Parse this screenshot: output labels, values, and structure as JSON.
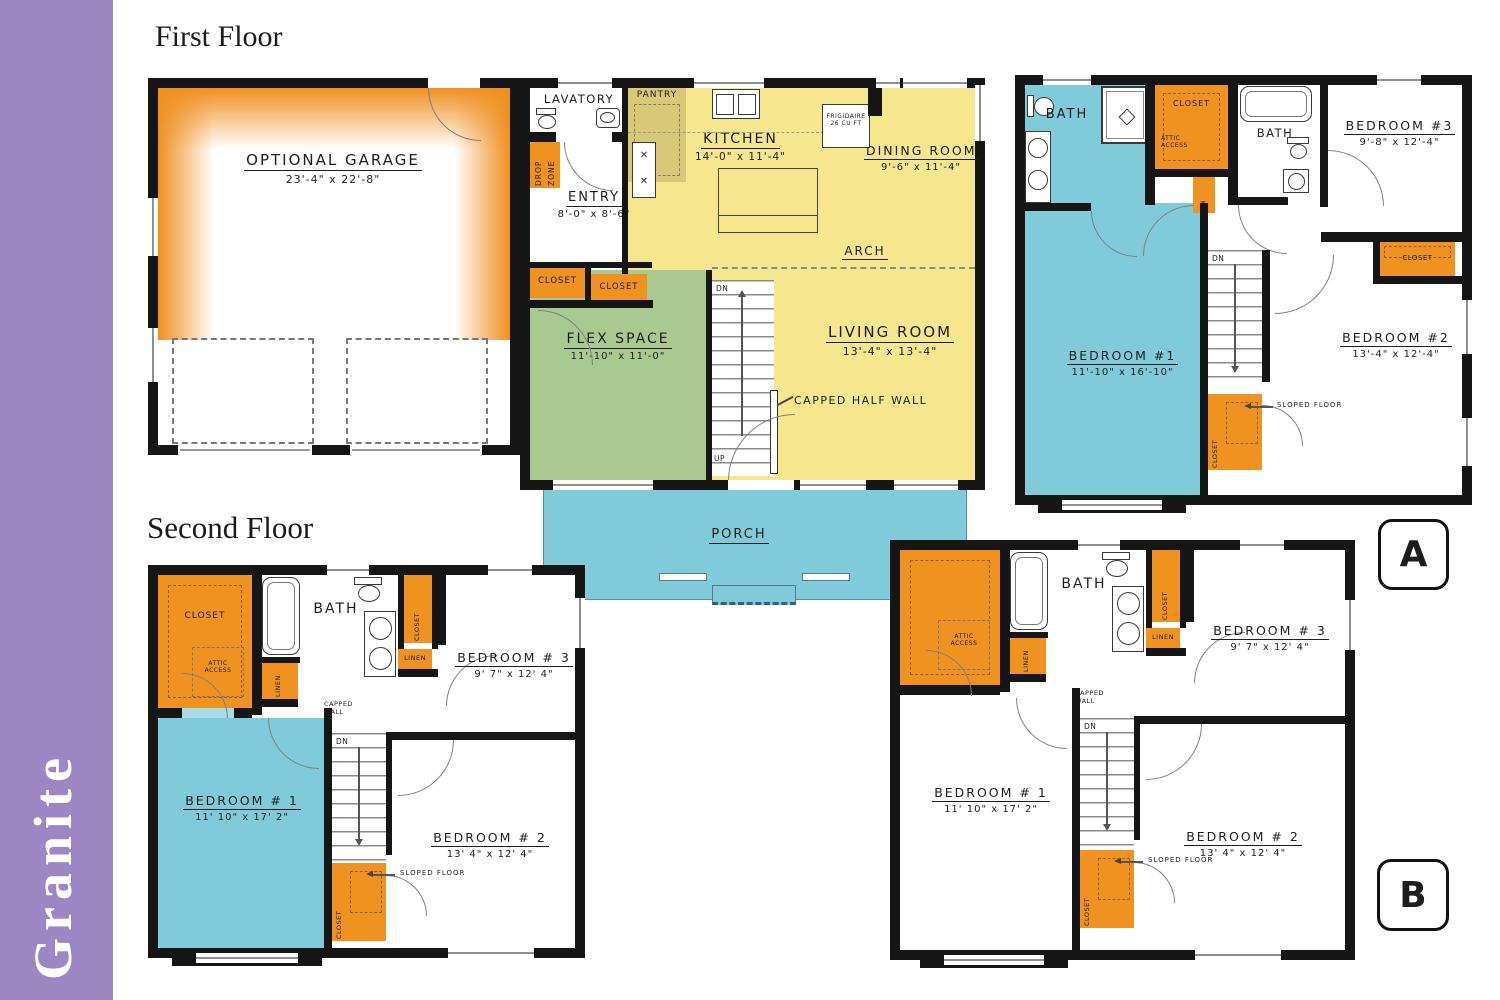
{
  "sidebar": {
    "title": "Granite"
  },
  "sections": {
    "first": "First Floor",
    "second": "Second Floor"
  },
  "badges": {
    "a": "A",
    "b": "B"
  },
  "colors": {
    "purple": "#9c86c3",
    "orange": "#f09220",
    "yellow": "#f6e68d",
    "tan": "#d8c878",
    "green": "#a8ca90",
    "teal": "#80cbd9",
    "wall": "#161616"
  },
  "ff": {
    "garage": {
      "name": "OPTIONAL GARAGE",
      "dims": "23'-4\" x 22'-8\""
    },
    "lavatory": "LAVATORY",
    "pantry": "PANTRY",
    "kitchen": {
      "name": "KITCHEN",
      "dims": "14'-0\" x 11'-4\""
    },
    "fridge": {
      "line1": "FRIGIDAIRE",
      "line2": "26 CU FT"
    },
    "dining": {
      "name": "DINING ROOM",
      "dims": "9'-6\" x 11'-4\""
    },
    "entry": {
      "name": "ENTRY",
      "dims": "8'-0\" x 8'-6\""
    },
    "drop_zone": "DROP ZONE",
    "closet_a": "CLOSET",
    "closet_b": "CLOSET",
    "flex": {
      "name": "FLEX SPACE",
      "dims": "11'-10\" x 11'-0\""
    },
    "living": {
      "name": "LIVING ROOM",
      "dims": "13'-4\" x 13'-4\""
    },
    "arch": "ARCH",
    "capped_half_wall": "CAPPED HALF WALL",
    "stairs": {
      "dn": "DN",
      "up": "UP"
    },
    "porch": "PORCH"
  },
  "sf": {
    "closet": "CLOSET",
    "attic": {
      "line1": "ATTIC",
      "line2": "ACCESS"
    },
    "bath": "BATH",
    "linen1": "LINEN",
    "closet_b3": "CLOSET",
    "linen2": "LINEN",
    "bedroom3": {
      "name": "BEDROOM # 3",
      "dims": "9' 7\" x 12' 4\""
    },
    "capped_wall": {
      "line1": "CAPPED",
      "line2": "WALL"
    },
    "bedroom1": {
      "name": "BEDROOM # 1",
      "dims": "11' 10\" x 17' 2\""
    },
    "bedroom2": {
      "name": "BEDROOM # 2",
      "dims": "13' 4\" x 12' 4\""
    },
    "sloped_floor": "SLOPED FLOOR",
    "closet_stairs": "CLOSET",
    "dn": "DN"
  },
  "pa": {
    "bath1": "BATH",
    "closet": "CLOSET",
    "attic": {
      "line1": "ATTIC",
      "line2": "ACCESS"
    },
    "lin": "LIN",
    "bath2": "BATH",
    "bedroom3": {
      "name": "BEDROOM #3",
      "dims": "9'-8\" x 12'-4\""
    },
    "closet_b3": "CLOSET",
    "bedroom1": {
      "name": "BEDROOM #1",
      "dims": "11'-10\" x 16'-10\""
    },
    "bedroom2": {
      "name": "BEDROOM #2",
      "dims": "13'-4\" x 12'-4\""
    },
    "sloped_floor": "SLOPED FLOOR",
    "closet_stairs": "CLOSET",
    "dn": "DN"
  },
  "pb": {
    "attic": {
      "line1": "ATTIC",
      "line2": "ACCESS"
    },
    "bath": "BATH",
    "linen1": "LINEN",
    "closet_b3": "CLOSET",
    "linen2": "LINEN",
    "bedroom3": {
      "name": "BEDROOM # 3",
      "dims": "9' 7\" x 12' 4\""
    },
    "capped_wall": {
      "line1": "CAPPED",
      "line2": "WALL"
    },
    "bedroom1": {
      "name": "BEDROOM # 1",
      "dims": "11' 10\" x 17' 2\""
    },
    "bedroom2": {
      "name": "BEDROOM # 2",
      "dims": "13' 4\" x 12' 4\""
    },
    "sloped_floor": "SLOPED FLOOR",
    "closet_stairs": "CLOSET",
    "dn": "DN"
  }
}
